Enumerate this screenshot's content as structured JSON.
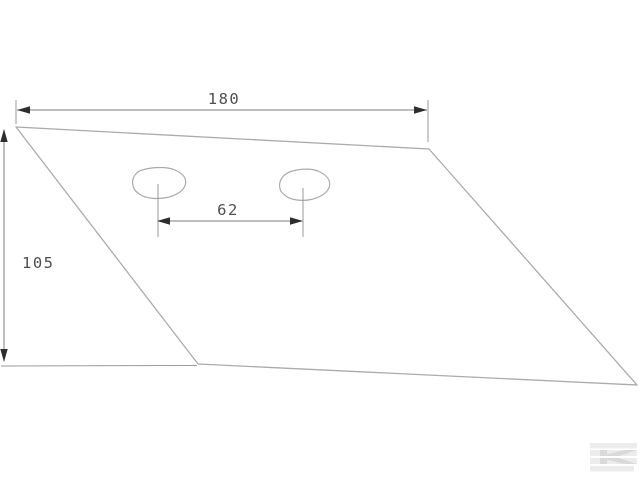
{
  "drawing": {
    "type": "technical-dimension-drawing",
    "part_shape": "quadrilateral plough share blade with two bolt holes",
    "dimensions": {
      "top_width_label": "180",
      "left_height_label": "105",
      "hole_spacing_label": "62"
    }
  },
  "watermark": {
    "glyph": "K"
  },
  "colors": {
    "background": "#ffffff",
    "outline": "#ababab",
    "extension_line": "#9a9a9a",
    "dimension_line": "#7d7d7d",
    "arrow": "#2e2e2e",
    "text": "#4f4f4f",
    "watermark_light": "#ececec",
    "watermark_dark": "#d9d9d9"
  }
}
